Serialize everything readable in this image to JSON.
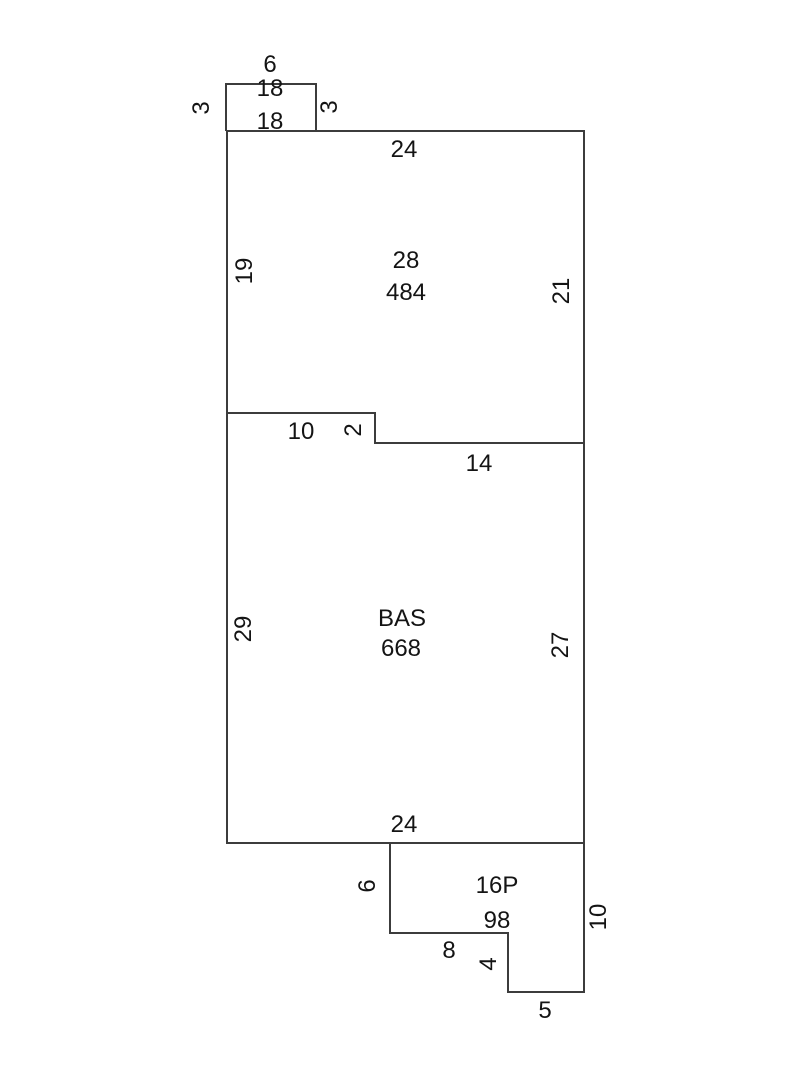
{
  "sketch": {
    "type": "floor-plan-sketch",
    "background_color": "#ffffff",
    "line_color": "#3c3c3c",
    "text_color": "#141414",
    "regions": [
      {
        "code": "18",
        "area": "18",
        "description": "small bump-out at top",
        "sides": {
          "top": "6",
          "left": "3",
          "right": "3"
        }
      },
      {
        "code": "28",
        "area": "484",
        "description": "upper section",
        "sides": {
          "top": "24",
          "left": "19",
          "right": "21",
          "step_bottom_left": "10",
          "step_drop": "2",
          "step_bottom_right": "14"
        }
      },
      {
        "code": "BAS",
        "area": "668",
        "description": "main basement section",
        "sides": {
          "left": "29",
          "right": "27",
          "bottom": "24"
        }
      },
      {
        "code": "16P",
        "area": "98",
        "description": "lower porch section",
        "sides": {
          "left": "6",
          "right": "10",
          "bottom_upper": "8",
          "step_drop": "4",
          "bottom_lower": "5"
        }
      }
    ],
    "labels": [
      {
        "text": "6",
        "role": "bump-top-width",
        "orientation": "horizontal"
      },
      {
        "text": "18",
        "role": "bump-code",
        "orientation": "horizontal"
      },
      {
        "text": "3",
        "role": "bump-left-height",
        "orientation": "vertical"
      },
      {
        "text": "3",
        "role": "bump-right-height",
        "orientation": "vertical"
      },
      {
        "text": "18",
        "role": "bump-area",
        "orientation": "horizontal"
      },
      {
        "text": "24",
        "role": "upper-top-width",
        "orientation": "horizontal"
      },
      {
        "text": "19",
        "role": "upper-left-height",
        "orientation": "vertical"
      },
      {
        "text": "28",
        "role": "upper-region-code",
        "orientation": "horizontal"
      },
      {
        "text": "484",
        "role": "upper-region-area",
        "orientation": "horizontal"
      },
      {
        "text": "21",
        "role": "upper-right-height",
        "orientation": "vertical"
      },
      {
        "text": "10",
        "role": "divider-step-width",
        "orientation": "horizontal"
      },
      {
        "text": "2",
        "role": "divider-step-drop",
        "orientation": "vertical"
      },
      {
        "text": "14",
        "role": "divider-lower-width",
        "orientation": "horizontal"
      },
      {
        "text": "29",
        "role": "bas-left-height",
        "orientation": "vertical"
      },
      {
        "text": "BAS",
        "role": "bas-region-code",
        "orientation": "horizontal"
      },
      {
        "text": "668",
        "role": "bas-region-area",
        "orientation": "horizontal"
      },
      {
        "text": "27",
        "role": "bas-right-height",
        "orientation": "vertical"
      },
      {
        "text": "24",
        "role": "bas-bottom-width",
        "orientation": "horizontal"
      },
      {
        "text": "6",
        "role": "porch-left-height",
        "orientation": "vertical"
      },
      {
        "text": "16P",
        "role": "porch-region-code",
        "orientation": "horizontal"
      },
      {
        "text": "98",
        "role": "porch-region-area",
        "orientation": "horizontal"
      },
      {
        "text": "8",
        "role": "porch-bottom-width-1",
        "orientation": "horizontal"
      },
      {
        "text": "4",
        "role": "porch-step-drop",
        "orientation": "vertical"
      },
      {
        "text": "10",
        "role": "porch-right-height",
        "orientation": "vertical"
      },
      {
        "text": "5",
        "role": "porch-bottom-width-2",
        "orientation": "horizontal"
      }
    ]
  }
}
